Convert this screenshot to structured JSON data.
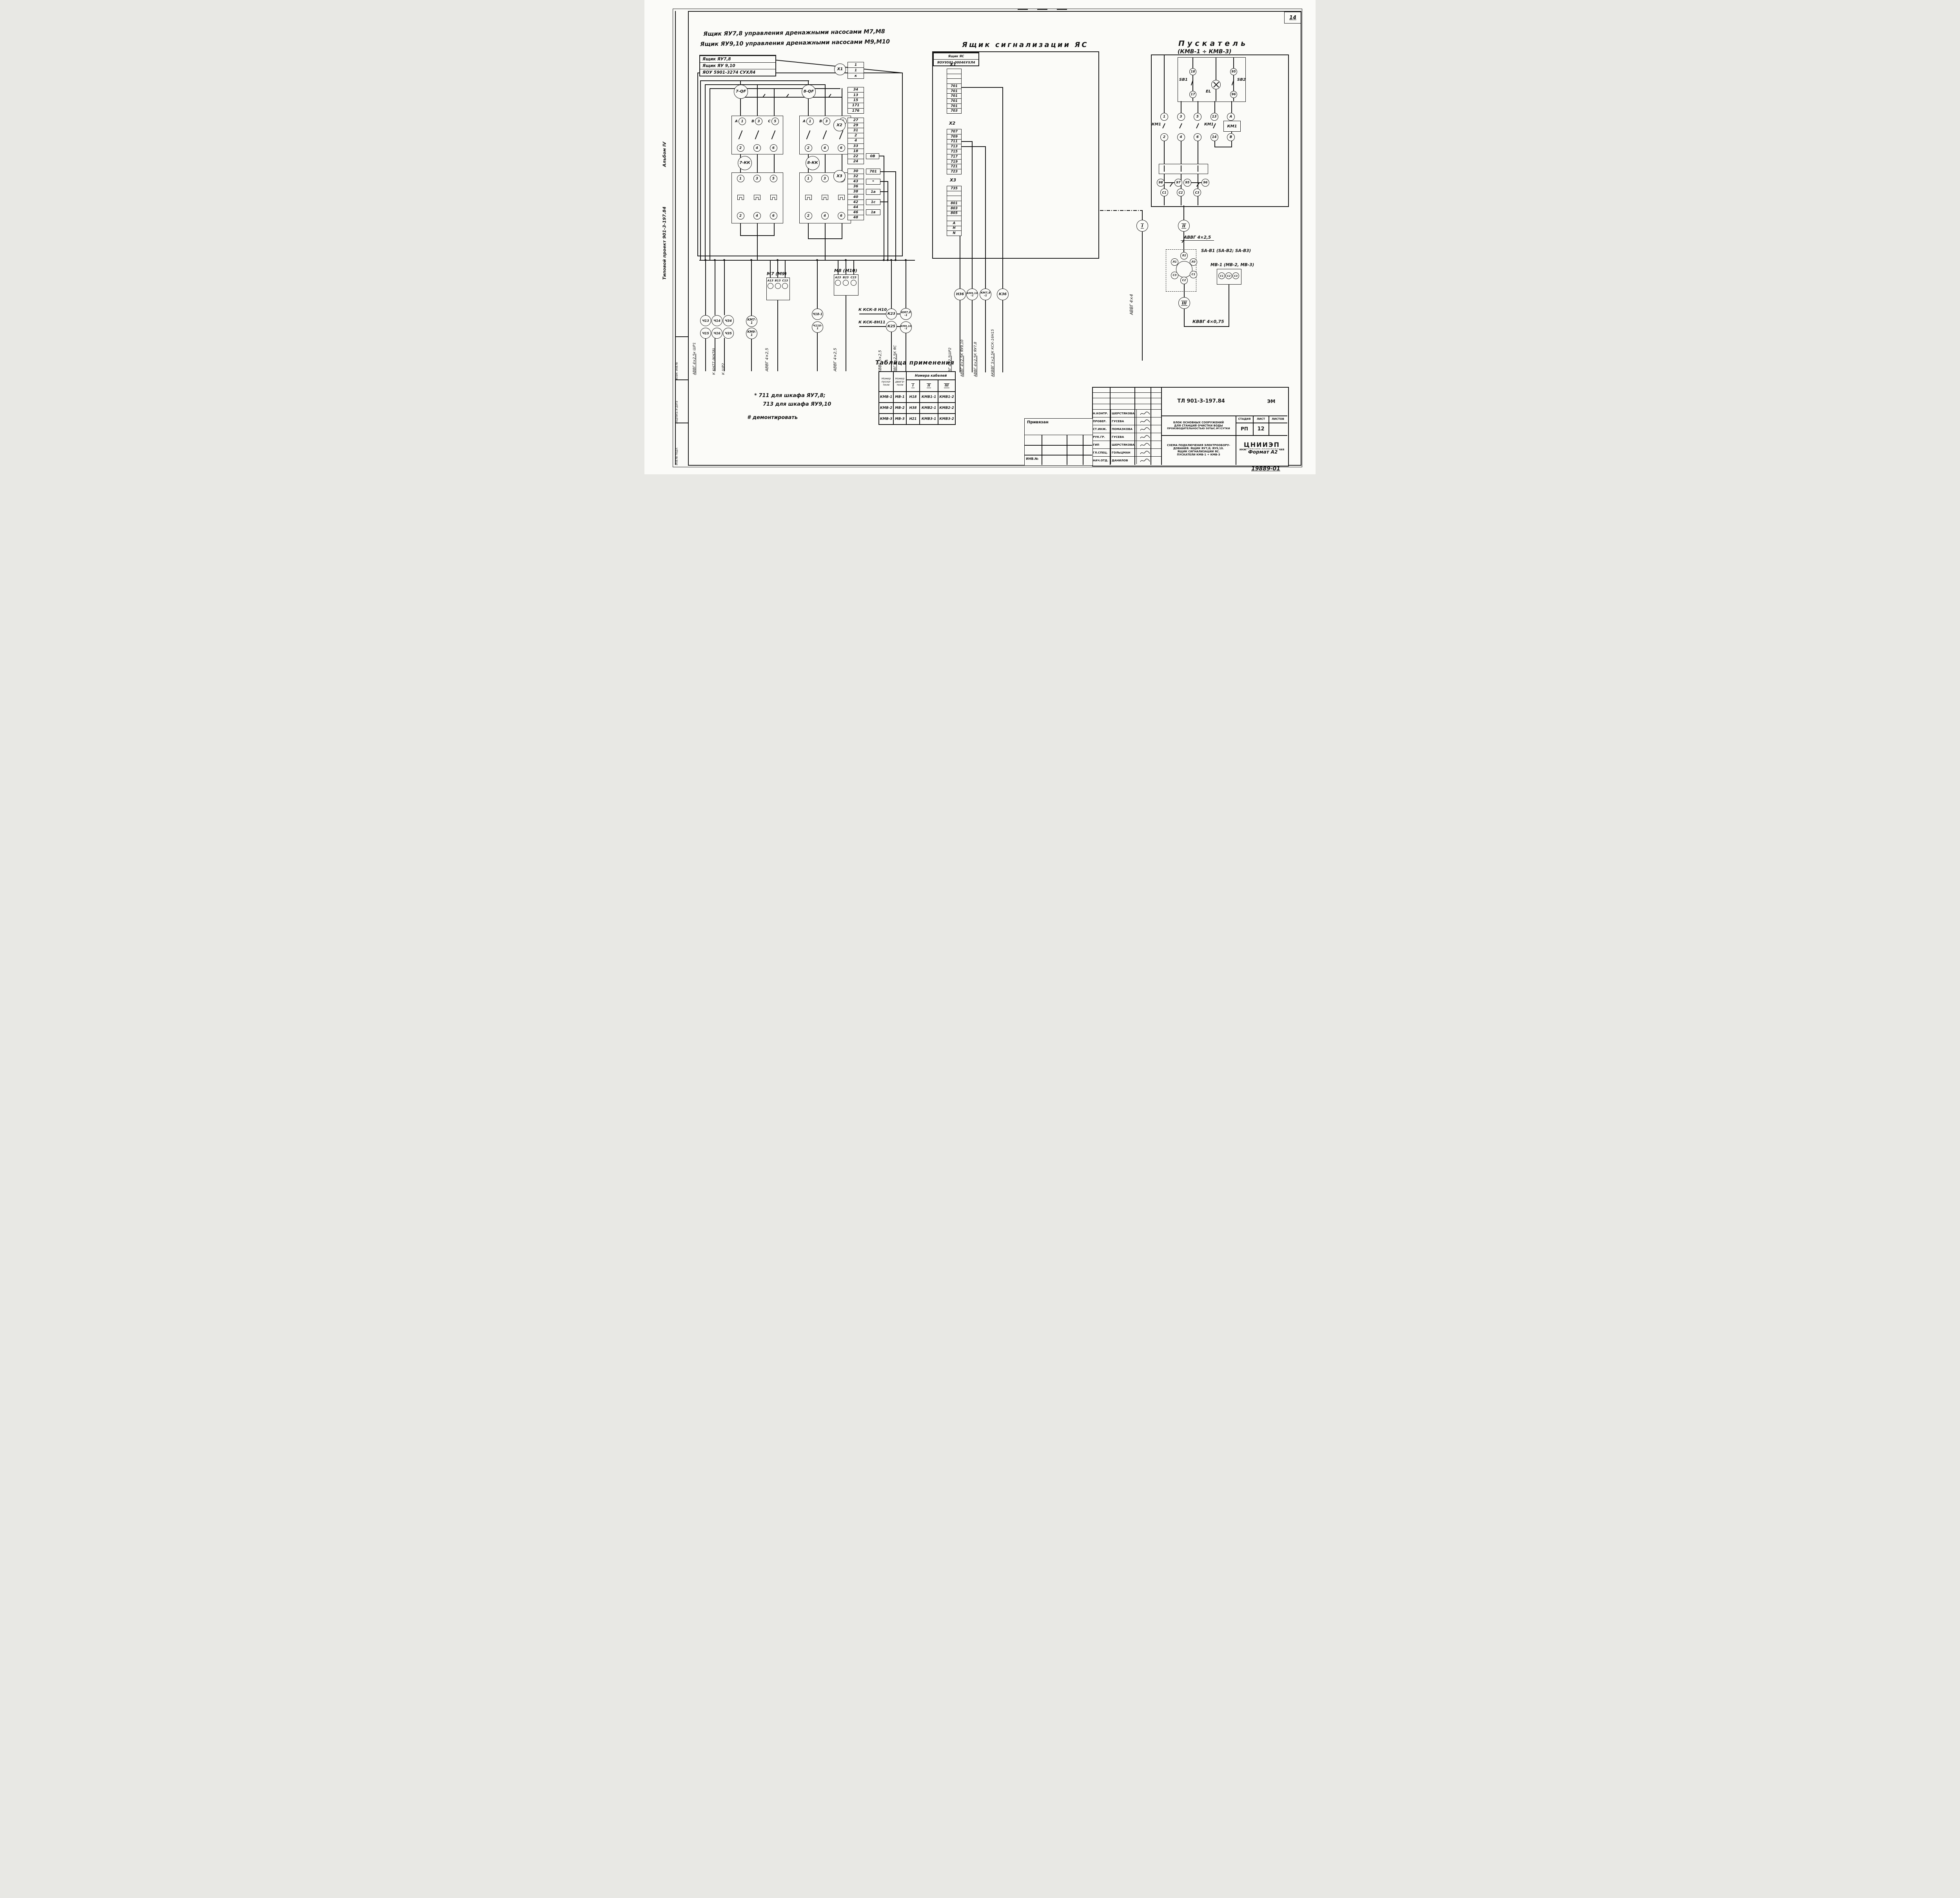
{
  "page": {
    "number": "14",
    "format": "Формат А2",
    "doc_number": "19889-01"
  },
  "margin": {
    "album": "Альбом IV",
    "project": "Типовой проект 901-3-197.84",
    "inv": "Инв.№ подл.",
    "sign": "Подпись и дата",
    "vzam": "Взам. инв.№"
  },
  "header": {
    "line1": "Ящик ЯУ7,8 управления дренажными насосами М7,М8",
    "line2": "Ящик ЯУ9,10 управления дренажными насосами М9,М10"
  },
  "left_unit": {
    "name_rows": [
      "Ящик ЯУ7,8",
      "Ящик ЯУ 9,10",
      "ЯОУ 5901-3274 СУХЛ4"
    ],
    "qf1": "7-QF",
    "qf2": "8-QF",
    "kk1": "7-КК",
    "kk2": "8-КК",
    "breaker_phases": [
      {
        "p": "А",
        "t": "1",
        "b": "2"
      },
      {
        "p": "В",
        "t": "3",
        "b": "4"
      },
      {
        "p": "С",
        "t": "5",
        "b": "6"
      }
    ],
    "kk_terms": [
      {
        "t": "1",
        "b": "2"
      },
      {
        "t": "3",
        "b": "4"
      },
      {
        "t": "5",
        "b": "6"
      }
    ],
    "x1_label": "X1",
    "x1_rows": [
      "1",
      "1",
      "к"
    ],
    "x1b_rows": [
      "34",
      "13",
      "15",
      "171",
      "176"
    ],
    "x2_label": "X2",
    "x2_rows": [
      "27",
      "29",
      "31",
      "2",
      "4",
      "33",
      "18",
      "22",
      "24"
    ],
    "x2_tag": "0В",
    "x3_label": "X3",
    "x3_rows": [
      "30",
      "32",
      "43",
      "36",
      "38",
      "40",
      "42",
      "44",
      "46",
      "48"
    ],
    "x3_tags": {
      "t30": "701",
      "t43": "*",
      "t38": "1а",
      "t42": "1с",
      "t46": "1в"
    },
    "circles_row1": [
      "Ч13",
      "Ч14",
      "Ч34"
    ],
    "circles_row2": [
      "Ч15",
      "Ч16",
      "Ч35"
    ],
    "km1": "КМ7-1",
    "km2": "КМ9-1",
    "motor1_label": "М7 (М9)",
    "motor1_terms": [
      "А13",
      "В13",
      "С13"
    ],
    "motor2_label": "М8 (М10)",
    "motor2_terms": [
      "А23",
      "В23",
      "С23"
    ],
    "circles2a": "Ч18-1",
    "circles2b": "Ч110-1",
    "cable_motor1": "АВВГ 4×2,5",
    "cable_motor2": "АВВГ 4×2,5",
    "ksk1": "К КСК-8 Н10",
    "ksk2": "К КСК-8Н11",
    "k23": "К23",
    "k25": "К25",
    "km78a": "КМ7,8",
    "km78b": "-1",
    "km910a": "КМ9,10",
    "km910b": "-1",
    "cable_akvvg": "АКВВГ 5×2,5",
    "cable_avvg_yas": "АВВГ 4×2,5",
    "to_yas": "К ЯС",
    "bl1a": "АВВГ 4×2,5",
    "bl1b": "к ШР1",
    "bl2": "К КН77 (КН78)",
    "bl3": "К ШР2"
  },
  "signal_box": {
    "title": "Ящик  сигнализации  ЯС",
    "name_rows": [
      "Ящик ЯС",
      "ЯОУ9501-00046УХЛ4"
    ],
    "x1_label": "X1",
    "x1_rows": [
      "",
      "",
      "",
      "701",
      "701",
      "701",
      "701",
      "701",
      "703"
    ],
    "x2_label": "X2",
    "x2_rows": [
      "707",
      "709",
      "711",
      "713",
      "715",
      "717",
      "719",
      "721",
      "723"
    ],
    "x3_label": "X3",
    "x3_rows": [
      "735",
      "",
      "",
      "801",
      "803",
      "805",
      "",
      "А",
      "Н",
      "N"
    ],
    "c1": "Н36",
    "c2a": "КМ9,10",
    "c2b": "-1",
    "c3a": "КМ7,8",
    "c3b": "-1",
    "c4": "К36",
    "cables": [
      {
        "name": "АВВГ 4×2,5",
        "dest": "ШР2"
      },
      {
        "name": "АВВГ 4×2,5",
        "dest": "К ЯУ9,10"
      },
      {
        "name": "АВВГ 4×2,5",
        "dest": "К ЯУ7,8"
      },
      {
        "name": "АКВВГ 5×2,5",
        "dest": "К КСК-16Н15"
      }
    ]
  },
  "starter": {
    "title": "Пускатель",
    "subtitle": "(КМВ-1 ÷ КМВ-3)",
    "sb1": "SB1",
    "sb2": "SB2",
    "el": "EL",
    "t18": "18",
    "t17": "17",
    "t95": "95",
    "t96": "96",
    "km_label": "КМ1",
    "km_box": "КМ1",
    "top_terms": [
      "1",
      "3",
      "5",
      "13",
      "А"
    ],
    "bottom_terms": [
      "2",
      "4",
      "6",
      "14",
      "В"
    ],
    "aux": [
      "98",
      "97",
      "95",
      "96"
    ],
    "c_terms": [
      "С1",
      "С2",
      "С3"
    ],
    "rom1": "I",
    "rom2": "II",
    "rom3": "III",
    "cable1": "АВВГ 4×4",
    "cable2": "АВВГ 4×2,5",
    "cable3": "КВВГ 4×0,75",
    "sa_label": "SA-В1 (SA-В2; SA-В3)",
    "sa": {
      "l1": "Л1",
      "l2": "Л2",
      "l3": "Л3",
      "c1": "С1",
      "c2": "С2",
      "c3": "С3"
    },
    "mv_label": "МВ-1 (МВ-2, МВ-3)",
    "mv_terms": [
      "С1",
      "С2",
      "С3"
    ]
  },
  "app_table": {
    "title": "Таблица применения",
    "h_starter": "Номер пуска­теля",
    "h_motor": "Номер двига­теля",
    "h_cables": "Номера кабелей",
    "subs": [
      "I",
      "II",
      "III"
    ],
    "rows": [
      [
        "КМВ-1",
        "МВ-1",
        "Н18",
        "КМВ1-1",
        "КМВ1-2"
      ],
      [
        "КМВ-2",
        "МВ-2",
        "Н38",
        "КМВ2-1",
        "КМВ2-2"
      ],
      [
        "КМВ-3",
        "МВ-3",
        "Н21",
        "КМВ3-1",
        "КМВ3-2"
      ]
    ]
  },
  "notes": {
    "n1": "* 711 для шкафа ЯУ7,8;",
    "n2": "713 для шкафа ЯУ9,10",
    "n3": "# демонтировать"
  },
  "titleblock": {
    "doc_code": "ТЛ 901-3-197.84",
    "type_code": "ЭМ",
    "privyazan": "Привязан",
    "inv_no": "ИНВ.№",
    "roles": [
      {
        "role": "Н.КОНТР.",
        "name": "ШЕРСТЯКОВА"
      },
      {
        "role": "ПРОВЕР.",
        "name": "ГУСЕВА"
      },
      {
        "role": "СТ.ИНЖ.",
        "name": "ПОМАЗКОВА"
      },
      {
        "role": "РУК.ГР.",
        "name": "ГУСЕВА"
      },
      {
        "role": "ГИП",
        "name": "ШЕРСТЯКОВА"
      },
      {
        "role": "ГЛ.СПЕЦ.",
        "name": "ГОЛЬЦМАН"
      },
      {
        "role": "НАЧ.ОТД.",
        "name": "ДАНИЛОВ"
      }
    ],
    "desc1a": "БЛОК ОСНОВНЫХ СООРУЖЕНИЙ",
    "desc1b": "ДЛЯ СТАНЦИЙ ОЧИСТКИ ВОДЫ",
    "desc1c": "ПРОИЗВОДИТЕЛЬНОСТЬЮ 50ТЫС.М³/СУТКИ",
    "desc2a": "СХЕМА ПОДКЛЮЧЕНИЯ ЭЛЕКТРООБОРУ-",
    "desc2b": "ДОВАНИЯ. ЯЩИК ЯУ7,8; ЯУ9,10.",
    "desc2c": "ЯЩИК СИГНАЛИЗАЦИИ ЯС.",
    "desc2d": "ПУСКАТЕЛИ КМВ-1 ÷ КМВ-3",
    "h_stage": "СТАДИЯ",
    "h_sheet": "ЛИСТ",
    "h_sheets": "ЛИСТОВ",
    "stage": "РП",
    "sheet": "12",
    "org1": "ЦНИИЭП",
    "org2": "ИНЖЕНЕРНОГО ОБОРУДОВАНИЯ",
    "org3": "Г. МОСКВА"
  }
}
